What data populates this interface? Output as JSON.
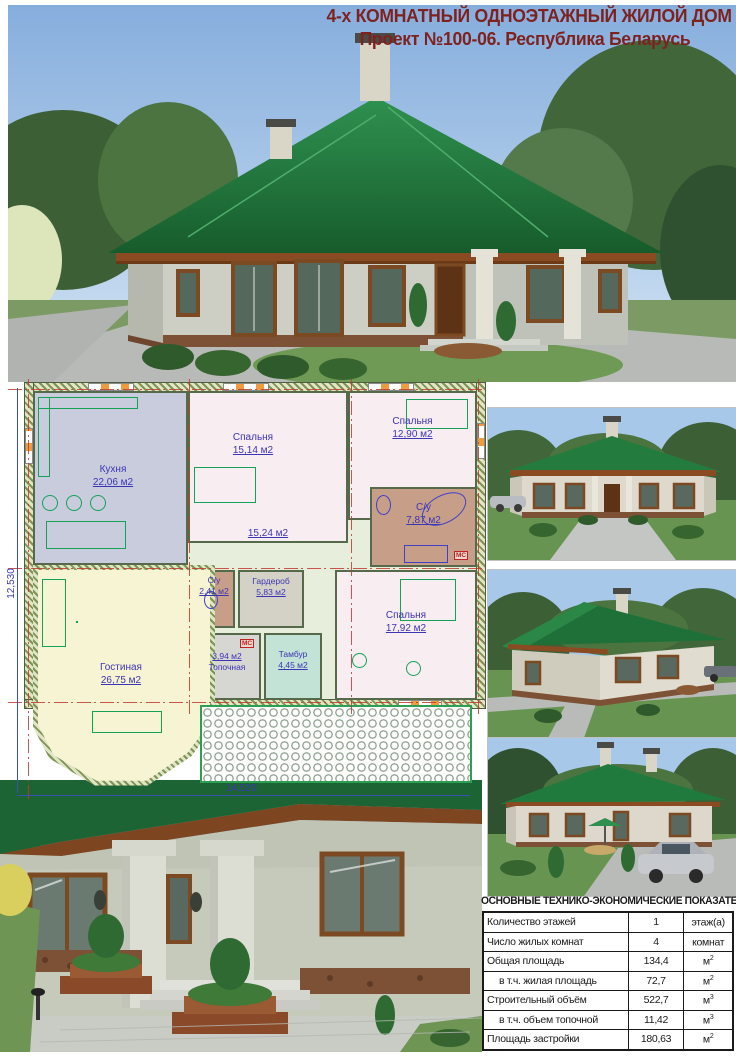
{
  "header": {
    "title_line1": "4-х КОМНАТНЫЙ ОДНОЭТАЖНЫЙ ЖИЛОЙ ДОМ",
    "title_line2": "Проект №100-06.  Республика Беларусь",
    "accent_color": "#7e2220"
  },
  "images": {
    "main_photo": "front-left exterior view, green hip roof house",
    "render_front": "front elevation render",
    "render_side": "side corner render",
    "render_rear": "rear view render with car",
    "entrance_photo": "entrance close-up photo"
  },
  "floor_plan": {
    "dim_left": "12,530",
    "dim_bottom": "14,520",
    "mc_badge": "МС",
    "colors": {
      "label": "#3c35b4",
      "furniture": "#14a257",
      "sanitary": "#4040c8",
      "axis": "#c23a2e",
      "roof_green": "#1d6434"
    },
    "rooms": [
      {
        "name": "Кухня",
        "area": "22,06 м2"
      },
      {
        "name": "Спальня",
        "area": "15,14 м2"
      },
      {
        "name": "Спальня",
        "area": "12,90 м2"
      },
      {
        "name": "С/у",
        "area": "7,87 м2"
      },
      {
        "name": "",
        "area": "15,24 м2"
      },
      {
        "name": "Гостиная",
        "area": "26,75 м2"
      },
      {
        "name": "С/у",
        "area": "2,41 м2"
      },
      {
        "name": "Гардероб",
        "area": "5,83 м2"
      },
      {
        "name": "Тамбур",
        "area": "4,45 м2"
      },
      {
        "name": "Топочная",
        "area": "3,94 м2"
      },
      {
        "name": "Спальня",
        "area": "17,92 м2"
      }
    ]
  },
  "table": {
    "title": "ОСНОВНЫЕ ТЕХНИКО-ЭКОНОМИЧЕСКИЕ ПОКАЗАТЕЛИ",
    "rows": [
      {
        "label": "Количество этажей",
        "value": "1",
        "unit": "этаж(а)",
        "unit_sup": ""
      },
      {
        "label": "Число жилых комнат",
        "value": "4",
        "unit": "комнат",
        "unit_sup": ""
      },
      {
        "label": "Общая площадь",
        "value": "134,4",
        "unit": "м",
        "unit_sup": "2"
      },
      {
        "label": "в т.ч. жилая площадь",
        "value": "72,7",
        "unit": "м",
        "unit_sup": "2"
      },
      {
        "label": "Строительный объём",
        "value": "522,7",
        "unit": "м",
        "unit_sup": "3"
      },
      {
        "label": "в т.ч. объем топочной",
        "value": "11,42",
        "unit": "м",
        "unit_sup": "3"
      },
      {
        "label": "Площадь застройки",
        "value": "180,63",
        "unit": "м",
        "unit_sup": "2"
      }
    ]
  }
}
